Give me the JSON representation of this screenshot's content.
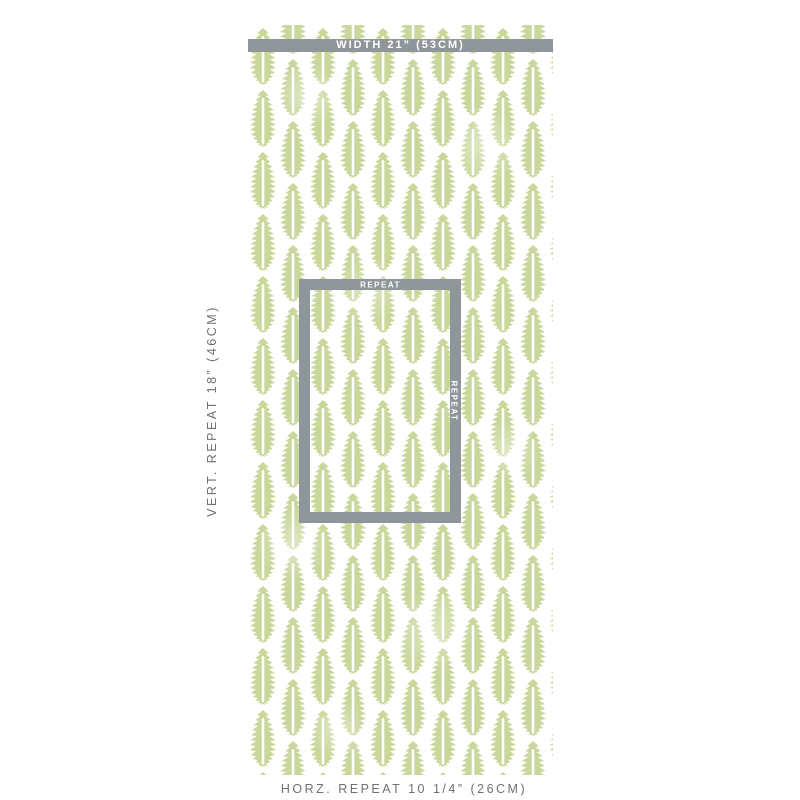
{
  "product": {
    "type": "wallpaper-swatch",
    "pattern_name": "leaf-motif"
  },
  "annotations": {
    "width_bar_label": "WIDTH 21” (53CM)",
    "vertical_repeat_label": "VERT. REPEAT 18” (46CM)",
    "horizontal_repeat_label": "HORZ. REPEAT 10 1/4” (26CM)",
    "repeat_box": {
      "top_label": "REPEAT",
      "side_label": "REPEAT"
    }
  },
  "colors": {
    "annotation_gray": "#8f969b",
    "label_text_gray": "#6d7277",
    "label_white": "#ffffff",
    "leaf_green": "#c9d79b",
    "swatch_background": "#ffffff",
    "page_white": "#ffffff"
  }
}
